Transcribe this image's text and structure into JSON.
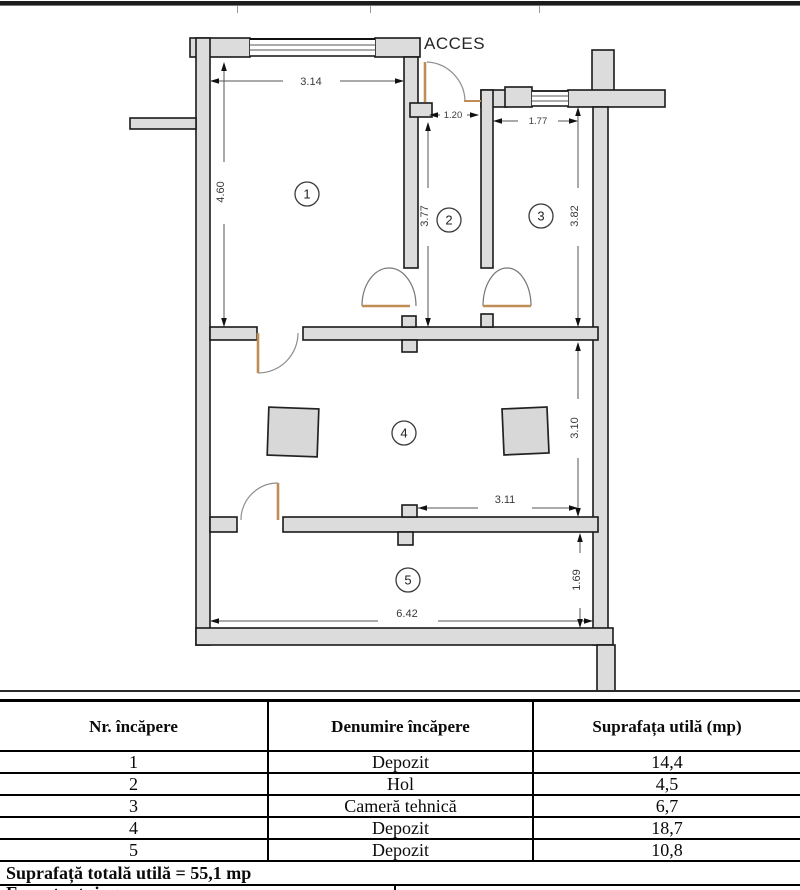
{
  "plan": {
    "acces_label": "ACCES",
    "rooms": [
      {
        "id": "1"
      },
      {
        "id": "2"
      },
      {
        "id": "3"
      },
      {
        "id": "4"
      },
      {
        "id": "5"
      }
    ],
    "dimensions": {
      "room1_width": "3.14",
      "room1_height": "4.60",
      "hall_width": "1.20",
      "hall_height": "3.77",
      "room3_width": "1.77",
      "room3_height": "3.82",
      "room4_height": "3.10",
      "room4_width": "3.11",
      "room5_height": "1.69",
      "room5_width": "6.42"
    },
    "colors": {
      "wall_fill": "#dcdcdc",
      "wall_stroke": "#1a1a1a",
      "door": "#c08d56",
      "dim_text": "#3a3a3a"
    }
  },
  "table": {
    "headers": [
      "Nr. încăpere",
      "Denumire încăpere",
      "Suprafața utilă (mp)"
    ],
    "rows": [
      {
        "nr": "1",
        "denumire": "Depozit",
        "suprafata": "14,4"
      },
      {
        "nr": "2",
        "denumire": "Hol",
        "suprafata": "4,5"
      },
      {
        "nr": "3",
        "denumire": "Cameră tehnică",
        "suprafata": "6,7"
      },
      {
        "nr": "4",
        "denumire": "Depozit",
        "suprafata": "18,7"
      },
      {
        "nr": "5",
        "denumire": "Depozit",
        "suprafata": "10,8"
      }
    ],
    "total_label": "Suprafață totală utilă = 55,1 mp",
    "footer_partial": "Executant: ing."
  }
}
